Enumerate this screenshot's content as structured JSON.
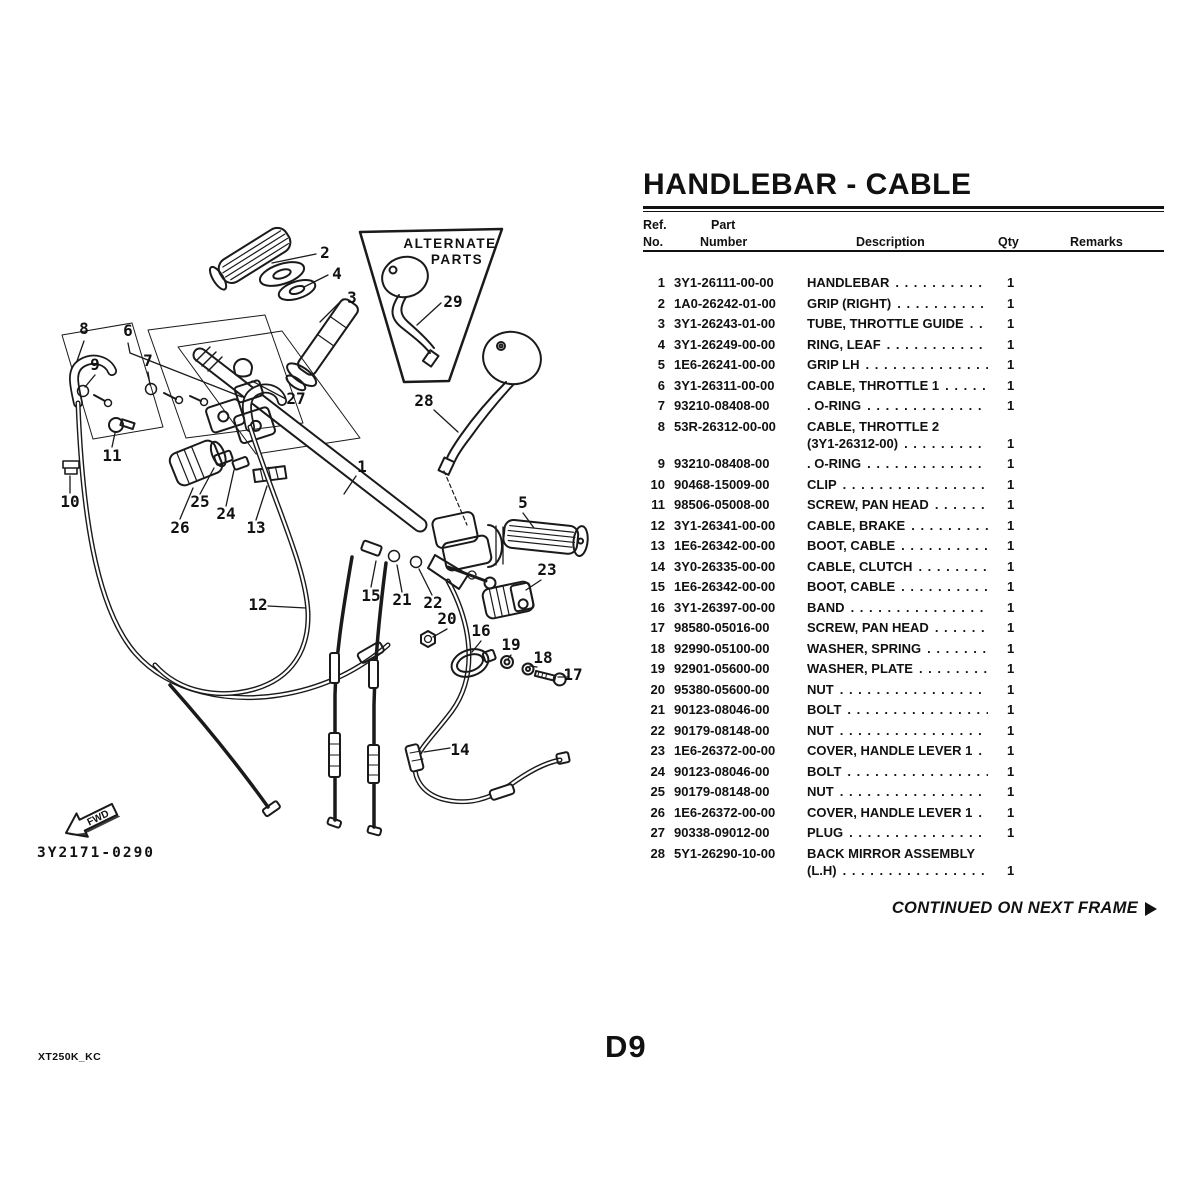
{
  "page": {
    "title": "HANDLEBAR - CABLE",
    "page_number": "D9",
    "doc_code": "XT250K_KC",
    "continued_label": "CONTINUED ON NEXT FRAME",
    "next_frame_arrow_icon": "right-arrowhead"
  },
  "diagram": {
    "drawing_number": "3Y2171-0290",
    "alternate_parts_line1": "ALTERNATE",
    "alternate_parts_line2": "PARTS",
    "fwd_label": "FWD",
    "callouts": [
      "2",
      "4",
      "3",
      "29",
      "28",
      "27",
      "8",
      "9",
      "6",
      "7",
      "11",
      "10",
      "26",
      "25",
      "24",
      "13",
      "1",
      "5",
      "23",
      "15",
      "21",
      "22",
      "12",
      "20",
      "16",
      "19",
      "18",
      "17",
      "14"
    ]
  },
  "table": {
    "headers": {
      "ref_line1": "Ref.",
      "ref_line2": "No.",
      "part_line1": "Part",
      "part_line2": "Number",
      "description": "Description",
      "qty": "Qty",
      "remarks": "Remarks"
    },
    "dot_leader": ". . . . . . . . . . . . . . . . . . . . . . . . . . . . . . . . . . . . . . . . . . . . . . . . . . . . . . . . . . . .",
    "rows": [
      {
        "ref": "1",
        "part": "3Y1-26111-00-00",
        "desc": "HANDLEBAR",
        "qty": "1"
      },
      {
        "ref": "2",
        "part": "1A0-26242-01-00",
        "desc": "GRIP (RIGHT)",
        "qty": "1"
      },
      {
        "ref": "3",
        "part": "3Y1-26243-01-00",
        "desc": "TUBE, THROTTLE GUIDE",
        "qty": "1"
      },
      {
        "ref": "4",
        "part": "3Y1-26249-00-00",
        "desc": "RING, LEAF",
        "qty": "1"
      },
      {
        "ref": "5",
        "part": "1E6-26241-00-00",
        "desc": "GRIP LH",
        "qty": "1"
      },
      {
        "ref": "6",
        "part": "3Y1-26311-00-00",
        "desc": "CABLE, THROTTLE 1",
        "qty": "1"
      },
      {
        "ref": "7",
        "part": "93210-08408-00",
        "desc": ". O-RING",
        "qty": "1"
      },
      {
        "ref": "8",
        "part": "53R-26312-00-00",
        "desc": "CABLE, THROTTLE 2",
        "desc2": "(3Y1-26312-00)",
        "qty": "1"
      },
      {
        "ref": "9",
        "part": "93210-08408-00",
        "desc": ". O-RING",
        "qty": "1"
      },
      {
        "ref": "10",
        "part": "90468-15009-00",
        "desc": "CLIP",
        "qty": "1"
      },
      {
        "ref": "11",
        "part": "98506-05008-00",
        "desc": "SCREW, PAN HEAD",
        "qty": "1"
      },
      {
        "ref": "12",
        "part": "3Y1-26341-00-00",
        "desc": "CABLE, BRAKE",
        "qty": "1"
      },
      {
        "ref": "13",
        "part": "1E6-26342-00-00",
        "desc": "BOOT, CABLE",
        "qty": "1"
      },
      {
        "ref": "14",
        "part": "3Y0-26335-00-00",
        "desc": "CABLE, CLUTCH",
        "qty": "1"
      },
      {
        "ref": "15",
        "part": "1E6-26342-00-00",
        "desc": "BOOT, CABLE",
        "qty": "1"
      },
      {
        "ref": "16",
        "part": "3Y1-26397-00-00",
        "desc": "BAND",
        "qty": "1"
      },
      {
        "ref": "17",
        "part": "98580-05016-00",
        "desc": "SCREW, PAN HEAD",
        "qty": "1"
      },
      {
        "ref": "18",
        "part": "92990-05100-00",
        "desc": "WASHER, SPRING",
        "qty": "1"
      },
      {
        "ref": "19",
        "part": "92901-05600-00",
        "desc": "WASHER, PLATE",
        "qty": "1"
      },
      {
        "ref": "20",
        "part": "95380-05600-00",
        "desc": "NUT",
        "qty": "1"
      },
      {
        "ref": "21",
        "part": "90123-08046-00",
        "desc": "BOLT",
        "qty": "1"
      },
      {
        "ref": "22",
        "part": "90179-08148-00",
        "desc": "NUT",
        "qty": "1"
      },
      {
        "ref": "23",
        "part": "1E6-26372-00-00",
        "desc": "COVER, HANDLE LEVER 1",
        "qty": "1"
      },
      {
        "ref": "24",
        "part": "90123-08046-00",
        "desc": "BOLT",
        "qty": "1"
      },
      {
        "ref": "25",
        "part": "90179-08148-00",
        "desc": "NUT",
        "qty": "1"
      },
      {
        "ref": "26",
        "part": "1E6-26372-00-00",
        "desc": "COVER, HANDLE LEVER 1",
        "qty": "1"
      },
      {
        "ref": "27",
        "part": "90338-09012-00",
        "desc": "PLUG",
        "qty": "1"
      },
      {
        "ref": "28",
        "part": "5Y1-26290-10-00",
        "desc": "BACK MIRROR ASSEMBLY",
        "desc2": "(L.H)",
        "qty": "1"
      }
    ]
  }
}
